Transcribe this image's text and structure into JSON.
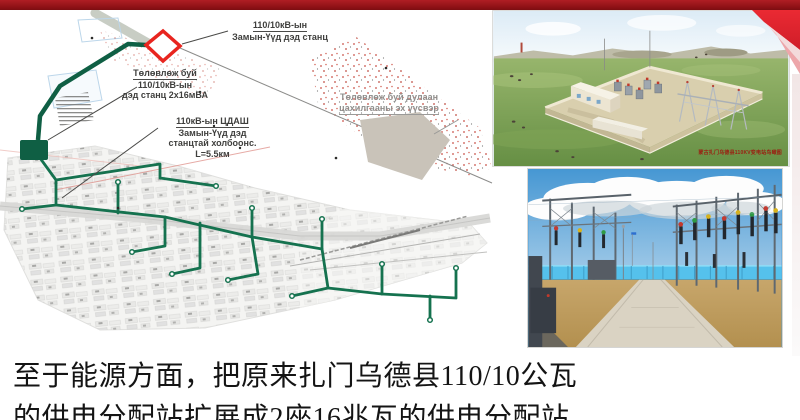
{
  "slide": {
    "colors": {
      "accent_bar": "#8f1116",
      "ribbon_red": "#e32430",
      "map_green": "#15724f",
      "marker_red": "#e8251f"
    }
  },
  "map": {
    "label_existing_substation": {
      "line1": "110/10кВ-ын",
      "line2": "Замын-Үүд дэд станц"
    },
    "label_planned_substation": {
      "line1": "Төлөвлөж буй",
      "line2": "110/10кВ-ын",
      "line3": "дэд станц 2х16мВА"
    },
    "label_transmission_line": {
      "line1": "110кВ-ын ЦДАШ",
      "line2": "Замын-Үүд дэд",
      "line3": "станцтай холбоонс.",
      "line4": "L=5.5км"
    },
    "label_thermal_source": {
      "line1": "Төлөвлөж буй дулаан",
      "line2": "цахилгааны эх үүсвэр"
    }
  },
  "images": {
    "render_caption": "蒙古扎门乌德县110KV变电站鸟瞰图"
  },
  "body": {
    "line1": "至于能源方面，把原来扎门乌德县110/10公瓦",
    "line2": "的供电分配站扩展成2座16兆瓦的供电分配站."
  }
}
